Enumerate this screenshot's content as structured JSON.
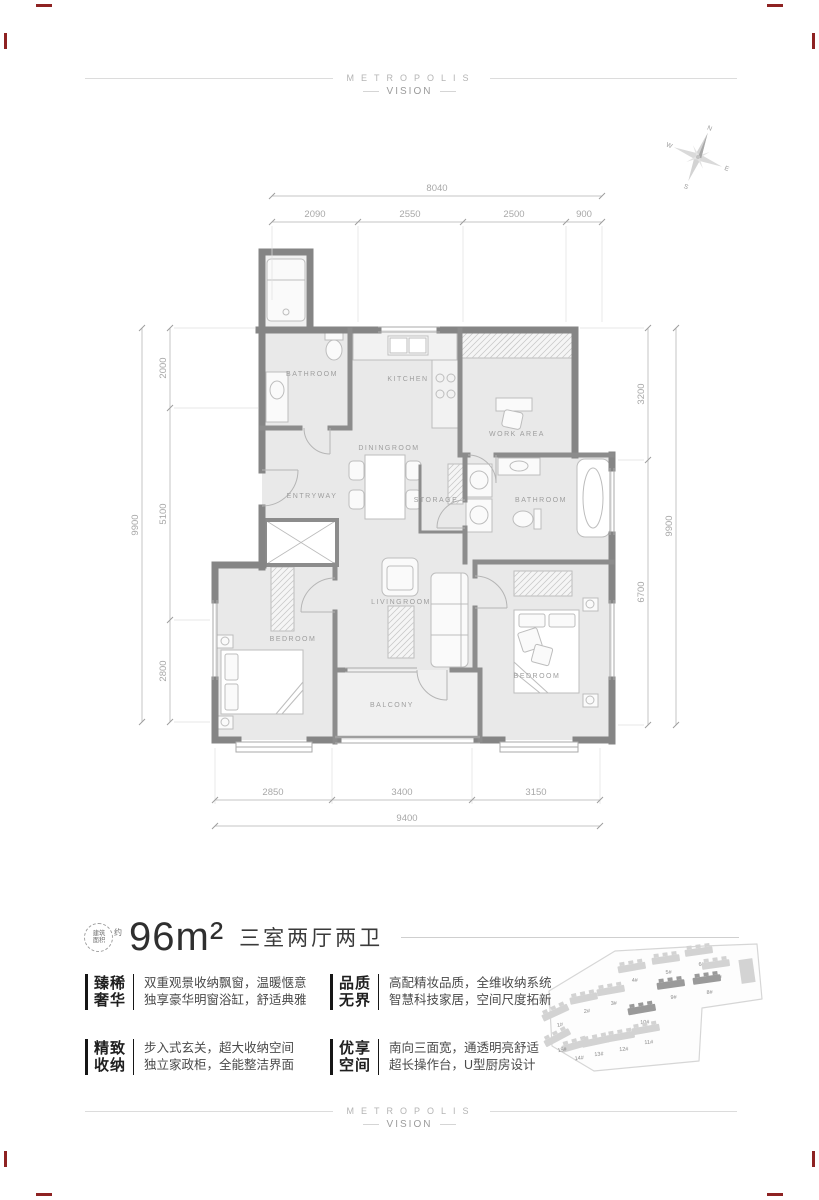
{
  "header": {
    "brand": "METROPOLIS",
    "sub": "VISION"
  },
  "footer": {
    "brand": "METROPOLIS",
    "sub": "VISION"
  },
  "summary": {
    "badge_line1": "建筑",
    "badge_line2": "面积",
    "badge_approx": "约",
    "area": "96m²",
    "layout": "三室两厅两卫"
  },
  "features": [
    {
      "title1": "臻稀",
      "title2": "奢华",
      "desc1": "双重观景收纳飘窗，温暖惬意",
      "desc2": "独享豪华明窗浴缸，舒适典雅"
    },
    {
      "title1": "精致",
      "title2": "收纳",
      "desc1": "步入式玄关，超大收纳空间",
      "desc2": "独立家政柜，全能整洁界面"
    },
    {
      "title1": "品质",
      "title2": "无界",
      "desc1": "高配精妆品质，全维收纳系统",
      "desc2": "智慧科技家居，空间尺度拓新"
    },
    {
      "title1": "优享",
      "title2": "空间",
      "desc1": "南向三面宽，通透明亮舒适",
      "desc2": "超长操作台，U型厨房设计"
    }
  ],
  "floorplan": {
    "rooms": [
      "BATHROOM",
      "KITCHEN",
      "WORK AREA",
      "DININGROOM",
      "ENTRYWAY",
      "STORAGE",
      "BATHROOM",
      "LIVINGROOM",
      "BEDROOM",
      "BALCONY",
      "BEDROOM"
    ],
    "dims": {
      "top": {
        "total": "8040",
        "segments": [
          "2090",
          "2550",
          "2500",
          "900"
        ]
      },
      "bottom": {
        "total": "9400",
        "segments": [
          "2850",
          "3400",
          "3150"
        ]
      },
      "left": {
        "total": "9900",
        "segments": [
          "2000",
          "5100",
          "2800"
        ]
      },
      "right": {
        "total": "9900",
        "segments": [
          "3200",
          "6700"
        ]
      }
    },
    "compass": {
      "n": "N",
      "e": "E",
      "s": "S",
      "w": "W"
    }
  },
  "siteplan": {
    "light_color": "#d3d3d3",
    "dark_color": "#9a9a9a",
    "label_color": "#8a8a8a",
    "buildings": [
      {
        "label": "1#",
        "x": 556,
        "y": 1014,
        "r": -25,
        "dark": false
      },
      {
        "label": "2#",
        "x": 584,
        "y": 1000,
        "r": -12,
        "dark": false
      },
      {
        "label": "3#",
        "x": 611,
        "y": 992,
        "r": -10,
        "dark": false
      },
      {
        "label": "4#",
        "x": 632,
        "y": 969,
        "r": -10,
        "dark": false
      },
      {
        "label": "5#",
        "x": 666,
        "y": 961,
        "r": -8,
        "dark": false
      },
      {
        "label": "6#",
        "x": 699,
        "y": 953,
        "r": -8,
        "dark": false
      },
      {
        "label": "7#",
        "x": 716,
        "y": 966,
        "r": -8,
        "dark": false
      },
      {
        "label": "8#",
        "x": 707,
        "y": 981,
        "r": -8,
        "dark": true
      },
      {
        "label": "9#",
        "x": 671,
        "y": 986,
        "r": -8,
        "dark": true
      },
      {
        "label": "10#",
        "x": 642,
        "y": 1011,
        "r": -10,
        "dark": true
      },
      {
        "label": "11#",
        "x": 646,
        "y": 1031,
        "r": -10,
        "dark": false
      },
      {
        "label": "12#",
        "x": 621,
        "y": 1038,
        "r": -10,
        "dark": false
      },
      {
        "label": "13#",
        "x": 596,
        "y": 1043,
        "r": -12,
        "dark": false
      },
      {
        "label": "14#",
        "x": 576,
        "y": 1047,
        "r": -16,
        "dark": false
      },
      {
        "label": "15#",
        "x": 558,
        "y": 1039,
        "r": -28,
        "dark": false
      }
    ]
  }
}
